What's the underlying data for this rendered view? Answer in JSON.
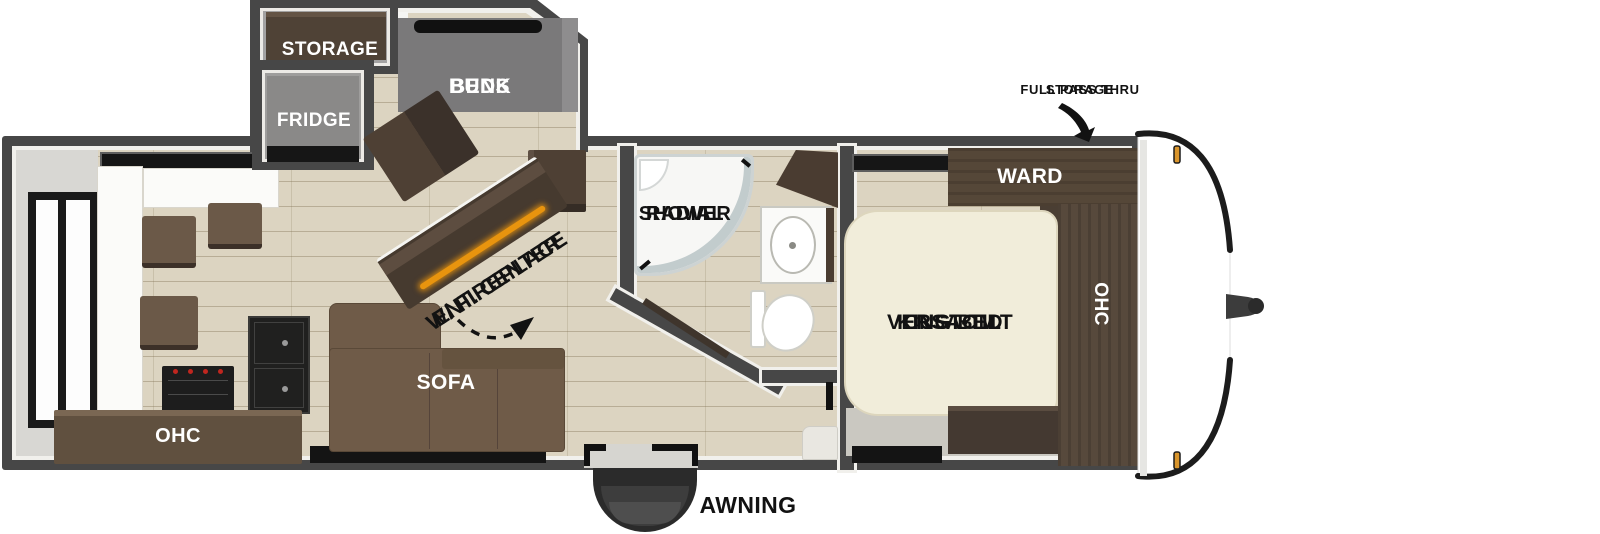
{
  "floorplan": {
    "slideout": {
      "storage": "STORAGE",
      "bunk_line1": "BUNK",
      "bunk_line2": "BEDS",
      "fridge": "FRIDGE"
    },
    "living": {
      "ent_line1": "ENT. CENTER",
      "ent_line2": "W/ FIREPLACE",
      "sofa": "SOFA",
      "ohc": "OHC"
    },
    "bath": {
      "shower_line1": "RADIAL",
      "shower_line2": "SHOWER"
    },
    "bedroom": {
      "bed_line1": "VERSA-TILT",
      "bed_line2": "CUSTOM",
      "bed_line3": "KING BED",
      "ward": "WARD",
      "ohc": "OHC"
    },
    "front": {
      "pass_line1": "FULL PASS THRU",
      "pass_line2": "STORAGE"
    },
    "exterior": {
      "awning": "AWNING"
    }
  },
  "colors": {
    "wall": "#474747",
    "liner": "#f1f0ec",
    "floor": "#dcd4c1",
    "slide_gray": "#9e9d9c",
    "bunk_gray": "#7a797a",
    "wood_dark": "#463a2f",
    "wood_mid": "#57493c",
    "sofa_brown": "#6f5b48",
    "bed_cream": "#f1edda",
    "fireplace_glow": "#e8940e",
    "marker_light": "#d9952c",
    "text_dark": "#111111",
    "text_light": "#ffffff"
  }
}
